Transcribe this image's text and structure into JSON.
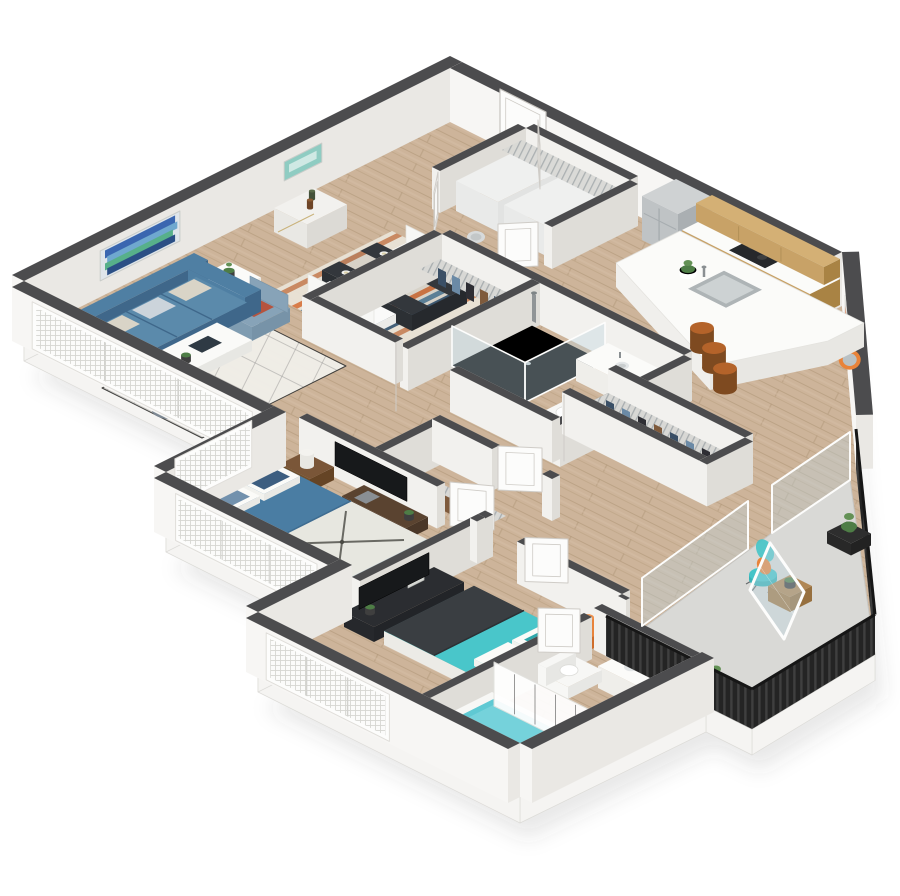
{
  "render": {
    "width": 900,
    "height": 896,
    "view": "isometric-3d-floor-plan"
  },
  "scene": {
    "description": "3D rendered floor plan of a two bedroom two bathroom apartment with balcony",
    "background": "#ffffff"
  },
  "palette": {
    "floorWood": "#cdb49a",
    "floorWoodLine": "#af9577",
    "balconyFloor": "#d9d9d6",
    "slab": "#f5f4f2",
    "slabEdge": "#dddcd8",
    "shadow": "rgba(70,70,70,0.12)",
    "wallTop": "#4c4c4e",
    "wallLight": "#f2f1ee",
    "wallMid": "#eceae6",
    "wallShade": "#dfddd8",
    "extLight": "#f7f6f4",
    "extShade": "#eae8e4",
    "glass": "rgba(188,214,224,0.38)",
    "frameWhite": "#fdfdfc",
    "mesh": "#fbfbfa",
    "meshLine": "#d6d6d2",
    "door": "#fcfcfb",
    "doorEdge": "#cfccc7",
    "sofa": "#4f7fa3",
    "sofaShade": "#3f678a",
    "armchair": "#87a3b8",
    "pouf": "#8e9aa4",
    "rug": "#f1efe9",
    "rugLine": "#45454a",
    "tableWhite": "#fafaf8",
    "tableDark": "#33373c",
    "woodDark": "#5a4330",
    "woodMid": "#7a5638",
    "stripeCream": "#e9e3d7",
    "stripeOrange": "#d97a45",
    "stripeBlue": "#5f87a0",
    "stripeNavy": "#3d5c77",
    "cabinetWood": "#c8a267",
    "cabinetWoodDark": "#a98344",
    "counterWhite": "#fbfbf9",
    "steel": "#bfc3c5",
    "steelShade": "#aaafb2",
    "steelTop": "#cfd2d3",
    "stoolWood": "#b4632a",
    "stoolDark": "#7e4a20",
    "orange": "#e8833a",
    "teal": "#45c4c8",
    "tealDark": "#2fa7ab",
    "bed1": "#4a7da3",
    "bed1White": "#eceae2",
    "headboard": "#8a5a33",
    "bed2": "#49c6ca",
    "bed2Throw": "#3a3e42",
    "charcoal": "#26282b",
    "tv": "#17191b",
    "consoleDark": "#2b2d31",
    "porcelain": "#f7f7f5",
    "porcelainShade": "#e7e7e4",
    "water": "#5fc9d3",
    "railing": "#242424",
    "railingSlat": "#3f3f3f",
    "shelf": "#d8d8d5",
    "wire": "#9fa5a8",
    "green": "#4e7d46",
    "greenLight": "#639155",
    "potDark": "#3f3f3f",
    "terracotta": "#b08755",
    "artCanvas": "#dfe5ea",
    "artBlue1": "#3a66b0",
    "artBlue2": "#6fa8cf",
    "artGreen": "#57b08a",
    "artNavy": "#2b4f85",
    "artTeal": "#8fccc2",
    "artTealLight": "#cfe9e4",
    "artFrameTeal": "#4aa6b8",
    "artOrange": "#e06a33",
    "mirrorOrange": "#e8833a",
    "mirrorGlass": "#b9c1c4",
    "lampWhite": "#f4f3ef",
    "flowerRed": "#c0392b",
    "denim1": "#3a4f66",
    "denim2": "#6b8aa6",
    "denim3": "#2e2e34",
    "denim4": "#7e5a3c"
  },
  "rooms": [
    {
      "name": "living-room",
      "furniture": [
        "blue-sofa",
        "accent-pillows",
        "armchair",
        "two-ottomans",
        "white-coffee-table",
        "geometric-area-rug",
        "side-tables-with-plants",
        "abstract-wall-art",
        "bar-cart"
      ]
    },
    {
      "name": "dining-area",
      "furniture": [
        "dark-dining-table",
        "four-white-chairs",
        "striped-area-rug",
        "place-settings",
        "small-wall-art"
      ]
    },
    {
      "name": "kitchen",
      "furniture": [
        "stainless-refrigerator",
        "wood-base-cabinets",
        "wood-upper-cabinets",
        "cooktop",
        "white-peninsula-counter",
        "undermount-sink",
        "three-wood-bar-stools",
        "framed-art",
        "round-orange-mirror"
      ]
    },
    {
      "name": "entry",
      "furniture": [
        "entry-door"
      ]
    },
    {
      "name": "laundry-closet",
      "furniture": [
        "washer",
        "dryer",
        "wire-shelf",
        "double-doors"
      ]
    },
    {
      "name": "hall-bathroom",
      "furniture": [
        "glass-shower",
        "vanity-sink",
        "toilet"
      ]
    },
    {
      "name": "hall-closets",
      "furniture": [
        "wire-shelving",
        "hanging-clothes"
      ]
    },
    {
      "name": "bedroom-1",
      "furniture": [
        "queen-bed-blue-compass-duvet",
        "wood-headboard",
        "nightstand",
        "cylinder-lamp",
        "wall-tv",
        "media-console",
        "windows"
      ]
    },
    {
      "name": "walk-in-closet",
      "furniture": [
        "wire-shelving",
        "hanging-clothes"
      ]
    },
    {
      "name": "bedroom-2",
      "furniture": [
        "queen-bed-teal",
        "charcoal-throw",
        "orange-nightstands",
        "orange-lamps",
        "tv-console",
        "tv",
        "window"
      ]
    },
    {
      "name": "bathroom-2",
      "furniture": [
        "double-vanity",
        "toilet",
        "bathtub",
        "shower-curtain"
      ]
    },
    {
      "name": "balcony",
      "furniture": [
        "sliding-glass-door",
        "teal-wire-chair",
        "orange-cushion",
        "wood-cube-table",
        "planter-boxes",
        "black-railing"
      ]
    }
  ]
}
